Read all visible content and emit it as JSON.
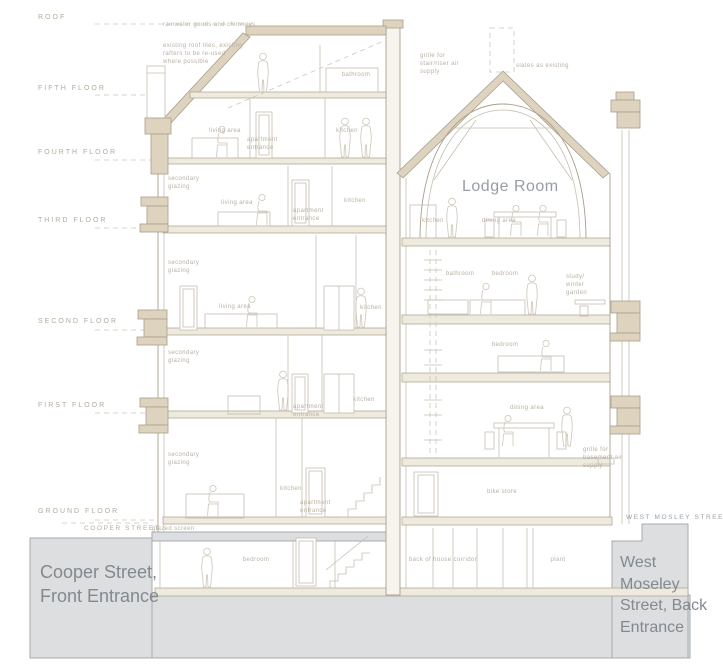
{
  "title": "Lodge Room",
  "floor_levels": [
    "ROOF",
    "FIFTH FLOOR",
    "FOURTH FLOOR",
    "THIRD FLOOR",
    "SECOND FLOOR",
    "FIRST FLOOR",
    "GROUND FLOOR"
  ],
  "street_levels": {
    "left": "COOPER STREET",
    "right": "WEST MOSLEY STREET"
  },
  "entrances": {
    "left": "Cooper Street, Front Entrance",
    "right": "West Moseley Street, Back Entrance"
  },
  "annotations": {
    "roof_edge": "rainwater goods and chimneys",
    "roof_construction": "existing roof tiles, existing rafters to be re-used where possible",
    "stair_riser": "grille for stair/riser air supply",
    "roof_right": "slates as existing",
    "glazed_screen": "glazed screen",
    "basement_grille": "grille for basement air supply"
  },
  "rooms": [
    "bathroom",
    "living area",
    "apartment entrance",
    "kitchen",
    "secondary glazing",
    "living area",
    "apartment entrance",
    "kitchen",
    "secondary glazing",
    "living area",
    "kitchen",
    "secondary glazing",
    "apartment entrance",
    "kitchen",
    "secondary glazing",
    "kitchen",
    "apartment entrance",
    "bedroom",
    "kitchen",
    "dining area",
    "bathroom",
    "bedroom",
    "study/ winter garden",
    "bedroom",
    "dining area",
    "bike store",
    "back of house corridor",
    "plant"
  ],
  "colors": {
    "tan_fill": "#ddd3bf",
    "line": "#c6bfb1",
    "grey_mass": "#dcdedf",
    "entrance_text": "#82898f",
    "label_text": "#b9b1a1"
  }
}
